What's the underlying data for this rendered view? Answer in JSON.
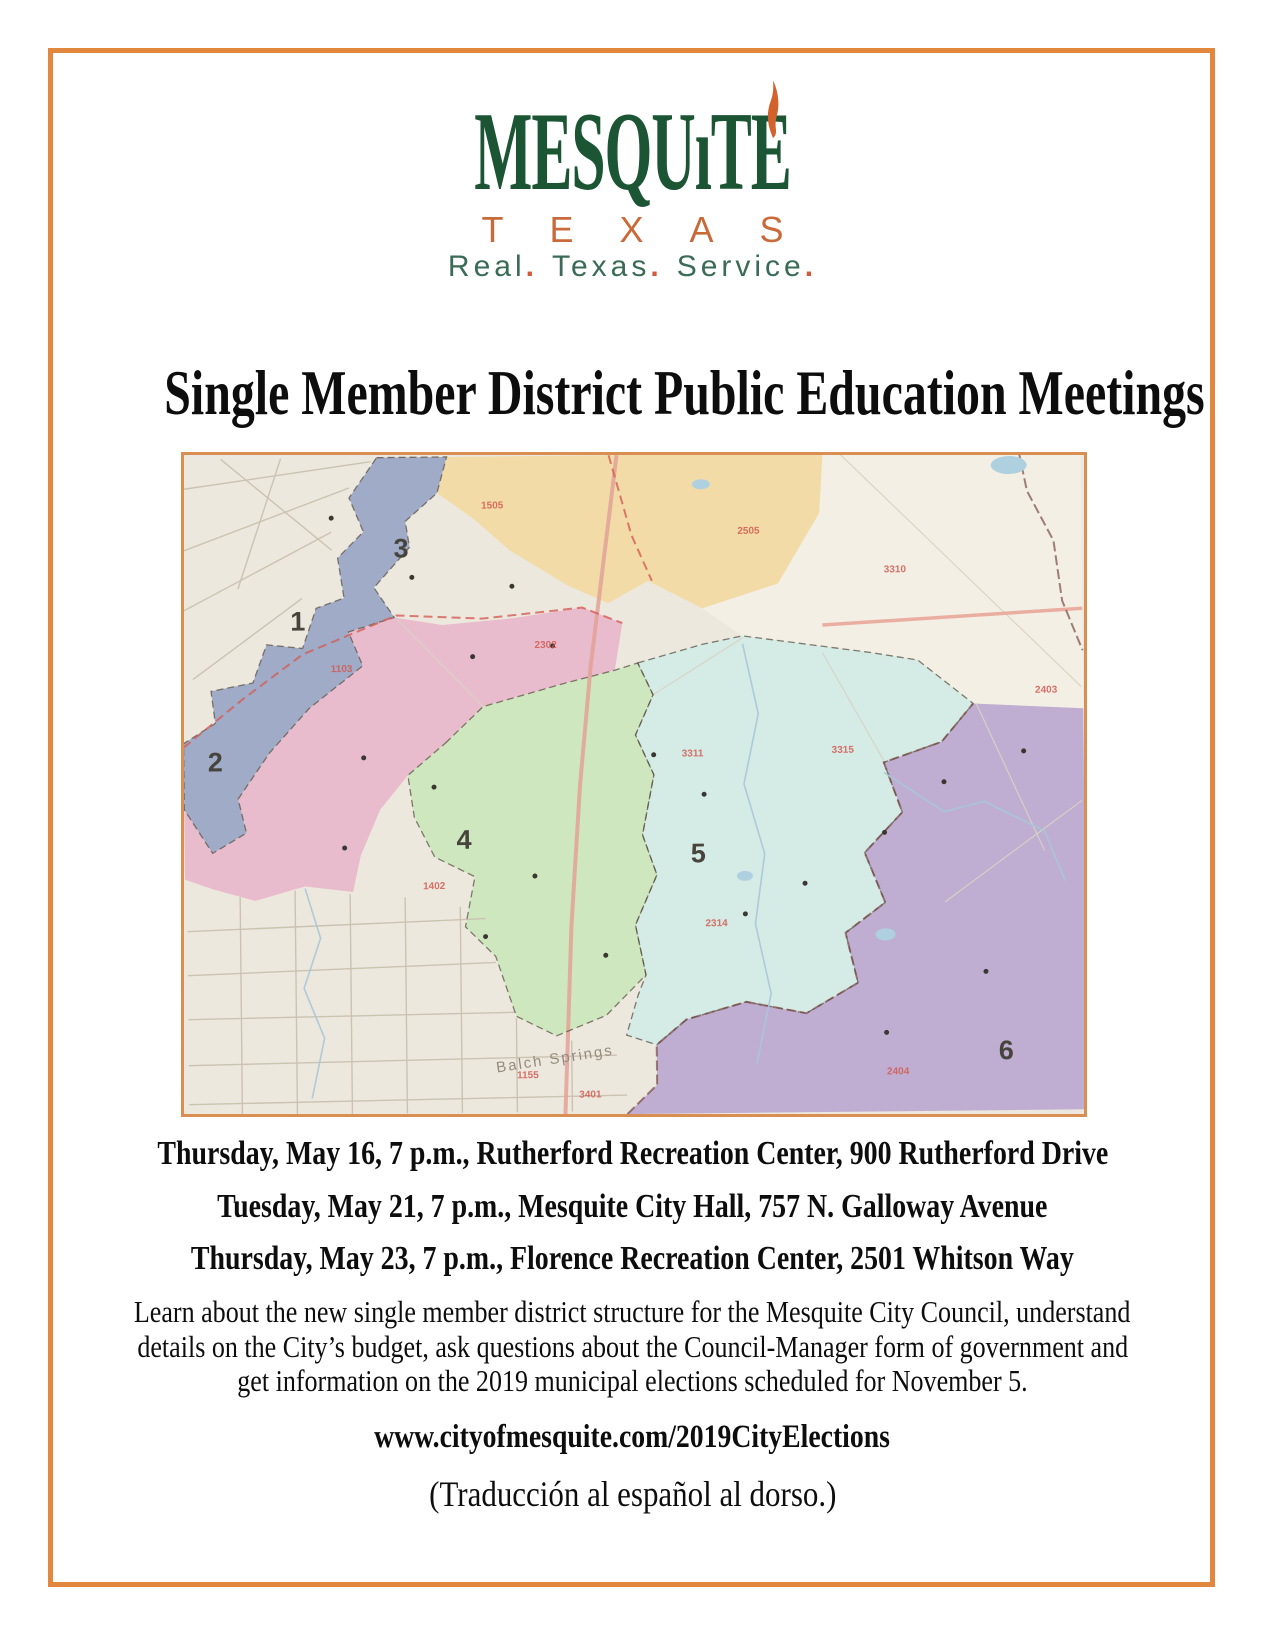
{
  "page": {
    "background": "#ffffff",
    "border_color": "#E2883E"
  },
  "logo": {
    "word_pre": "MESQU",
    "word_i": "ı",
    "word_post": "TE",
    "word_color": "#1B5534",
    "flame_color": "#D2612C",
    "texas": "TEXAS",
    "texas_color": "#C96A3A",
    "tagline_words": [
      "Real",
      "Texas",
      "Service"
    ],
    "tagline_separator": ".",
    "tagline_color": "#3A6B57",
    "tagline_dot_color": "#D05A3A"
  },
  "title": "Single Member District Public Education Meetings",
  "map": {
    "background": "#EDE8DF",
    "frame_color": "#D98F52",
    "districts": [
      {
        "number": "1",
        "color": "#97A4C6",
        "label_x": 108,
        "label_y": 172
      },
      {
        "number": "2",
        "color": "#E8B7CC",
        "label_x": 24,
        "label_y": 312
      },
      {
        "number": "3",
        "color": "#F2DAA2",
        "label_x": 212,
        "label_y": 100
      },
      {
        "number": "4",
        "color": "#CBE7BC",
        "label_x": 272,
        "label_y": 392
      },
      {
        "number": "5",
        "color": "#D2EBE8",
        "label_x": 506,
        "label_y": 408
      },
      {
        "number": "6",
        "color": "#B9A8D1",
        "label_x": 812,
        "label_y": 608
      }
    ],
    "place_label": {
      "text": "Balch Springs",
      "x": 310,
      "y": 616,
      "rotation": -8
    },
    "precinct_labels": [
      {
        "text": "1505",
        "x": 300,
        "y": 52
      },
      {
        "text": "2505",
        "x": 556,
        "y": 80
      },
      {
        "text": "3310",
        "x": 702,
        "y": 120
      },
      {
        "text": "1103",
        "x": 148,
        "y": 214
      },
      {
        "text": "2302",
        "x": 352,
        "y": 192
      },
      {
        "text": "3311",
        "x": 498,
        "y": 302
      },
      {
        "text": "3315",
        "x": 648,
        "y": 300
      },
      {
        "text": "2314",
        "x": 520,
        "y": 472
      },
      {
        "text": "1402",
        "x": 238,
        "y": 432
      },
      {
        "text": "1155",
        "x": 330,
        "y": 622
      },
      {
        "text": "3401",
        "x": 392,
        "y": 642
      },
      {
        "text": "2404",
        "x": 700,
        "y": 622
      },
      {
        "text": "2403",
        "x": 852,
        "y": 242
      }
    ]
  },
  "meetings": [
    "Thursday, May 16, 7 p.m., Rutherford Recreation Center, 900 Rutherford Drive",
    "Tuesday, May 21, 7 p.m., Mesquite City Hall, 757 N. Galloway Avenue",
    "Thursday, May 23, 7 p.m., Florence Recreation Center, 2501 Whitson Way"
  ],
  "description_lines": [
    "Learn about the new single member district structure for the Mesquite City Council, understand",
    "details on the City’s budget, ask questions about the Council-Manager form of government and",
    "get information on the 2019 municipal elections scheduled for November 5."
  ],
  "website": "www.cityofmesquite.com/2019CityElections",
  "translation_note": "(Traducción al español al dorso.)"
}
